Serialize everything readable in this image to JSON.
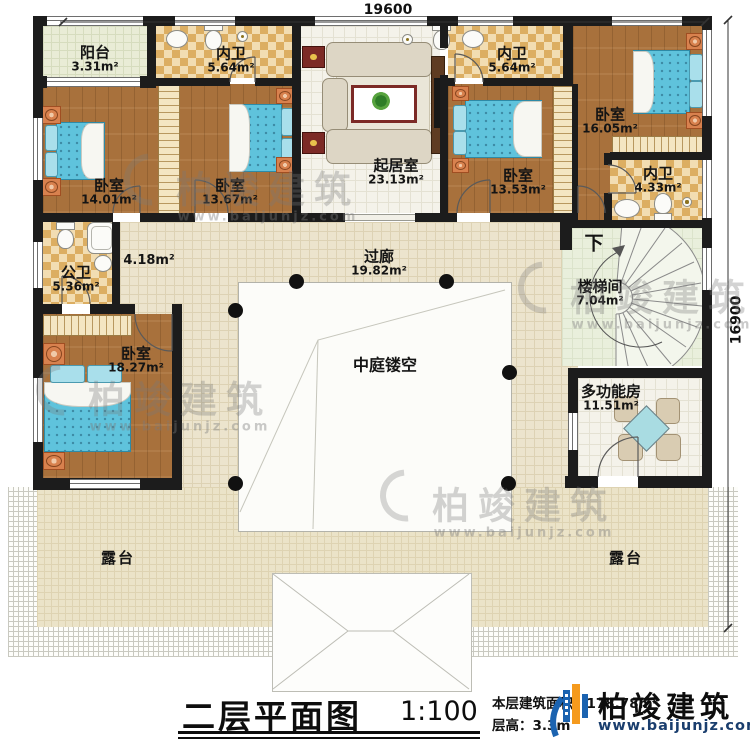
{
  "dimensions": {
    "width_label": "19600",
    "height_label": "16900"
  },
  "rooms": {
    "balcony": {
      "name": "阳台",
      "area": "3.31m²"
    },
    "bath_top_left": {
      "name": "内卫",
      "area": "5.64m²"
    },
    "living": {
      "name": "起居室",
      "area": "23.13m²"
    },
    "bath_top_right": {
      "name": "内卫",
      "area": "5.64m²"
    },
    "bedroom_tr": {
      "name": "卧室",
      "area": "16.05m²"
    },
    "bath_right": {
      "name": "内卫",
      "area": "4.33m²"
    },
    "stairwell": {
      "name": "楼梯间",
      "area": "7.04m²",
      "direction": "下"
    },
    "multi_room": {
      "name": "多功能房",
      "area": "11.51m²"
    },
    "bedroom_left": {
      "name": "卧室",
      "area": "14.01m²"
    },
    "bedroom_mid1": {
      "name": "卧室",
      "area": "13.67m²"
    },
    "bedroom_mid2": {
      "name": "卧室",
      "area": "13.53m²"
    },
    "public_bath": {
      "name": "公卫",
      "area": "5.36m²"
    },
    "hallway": {
      "area": "4.18m²"
    },
    "bedroom_bl": {
      "name": "卧室",
      "area": "18.27m²"
    },
    "corridor": {
      "name": "过廊",
      "area": "19.82m²"
    },
    "atrium": {
      "name": "中庭镂空"
    },
    "terrace_left": {
      "name": "露台"
    },
    "terrace_right": {
      "name": "露台"
    }
  },
  "title_block": {
    "title": "二层平面图",
    "scale": "1:100",
    "area_label": "本层建筑面积：",
    "area_value": "178.78m²",
    "floor_height_label": "层高：",
    "floor_height_value": "3.3m"
  },
  "brand": {
    "name": "柏竣建筑",
    "website": "www.baijunjz.com"
  },
  "watermark": {
    "text": "柏竣建筑",
    "website": "www.baijunjz.com"
  },
  "colors": {
    "wall": "#1c1c1c",
    "wood_floor": "#a8713c",
    "checker_tile": "#dcae62",
    "bed": "#5fc3dc",
    "terrace": "#ebe3c8",
    "logo_blue": "#1b63b0",
    "logo_orange": "#f59a1d"
  }
}
